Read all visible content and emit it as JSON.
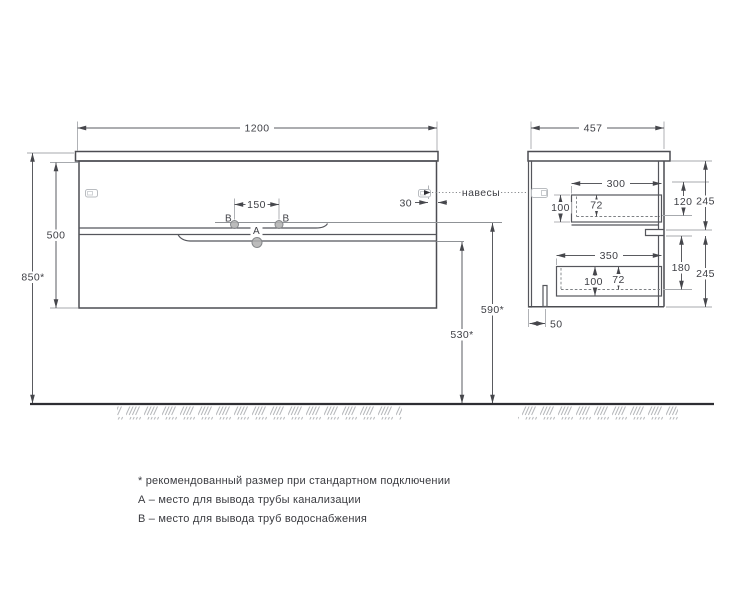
{
  "views": {
    "front": {
      "width": "1200",
      "height": "500",
      "mount_height": "850*",
      "supply_spacing": "150",
      "hanger_offset": "30",
      "supply_height": "590*",
      "drain_height": "530*",
      "point_a": "А",
      "point_b_left": "В",
      "point_b_right": "В"
    },
    "side": {
      "depth": "457",
      "top_drawer": {
        "depth": "300",
        "height": "100",
        "inner_height": "72",
        "clearance": "120",
        "front_height": "245"
      },
      "bottom_drawer": {
        "depth": "350",
        "height": "100",
        "inner_height": "72",
        "clearance": "180",
        "front_height": "245"
      },
      "back_offset": "50"
    },
    "callout_hangers": "навесы"
  },
  "footnotes": {
    "asterisk": "* рекомендованный размер при стандартном подключении",
    "point_a": "А – место для вывода трубы канализации",
    "point_b": "В – место для вывода труб водоснабжения"
  },
  "colors": {
    "line": "#4c4d52",
    "dim_text": "#3e3f45",
    "light_line": "#a7aaae",
    "point_fill": "#b0b0b0"
  }
}
